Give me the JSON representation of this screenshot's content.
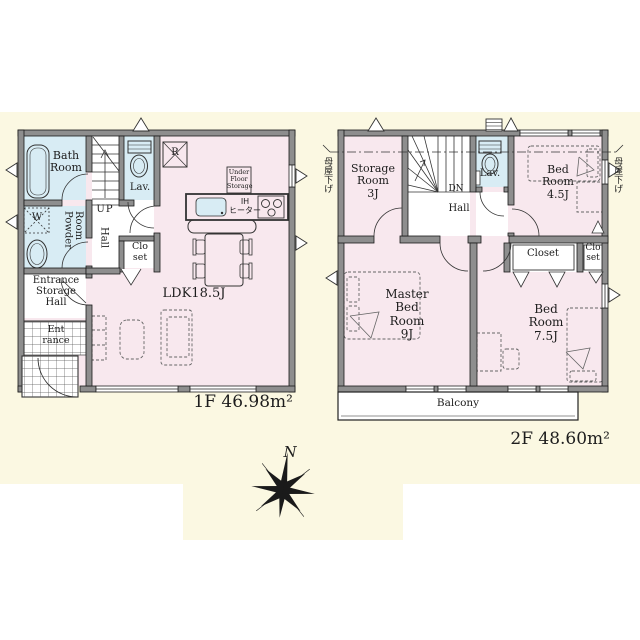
{
  "colors": {
    "canvas": "#ffffff",
    "panel": "#FBF8E2",
    "room_pink": "#F8E8EE",
    "room_blue": "#D8ECF4",
    "wall_gray": "#8E8E8E",
    "line": "#1c1c1c"
  },
  "floor1": {
    "area_label": "1F 46.98m²",
    "rooms": {
      "bath": "Bath\nRoom",
      "washer": "W",
      "powder": "Powder\nRoom",
      "lav": "Lav.",
      "up": "UP",
      "hall": "Hall",
      "closet": "Clo\nset",
      "entrance_storage": "Entrance\nStorage\nHall",
      "entrance": "Ent\nrance",
      "ldk": "LDK18.5J",
      "fridge": "R",
      "under_floor_storage": "Under\nFloor\nStorage",
      "ih_heater": "IH\nヒーター"
    }
  },
  "floor2": {
    "area_label": "2F 48.60m²",
    "roof_note_left": "母屋下げ",
    "roof_note_right": "母屋下げ",
    "rooms": {
      "storage": "Storage\nRoom\n3J",
      "dn": "DN",
      "hall": "Hall",
      "lav": "Lav.",
      "bed_45": "Bed\nRoom\n4.5J",
      "closet": "Closet",
      "closet_small": "Clo\nset",
      "master": "Master\nBed Room\n9J",
      "bed_75": "Bed\nRoom\n7.5J",
      "balcony": "Balcony"
    }
  },
  "compass": {
    "north": "N"
  }
}
